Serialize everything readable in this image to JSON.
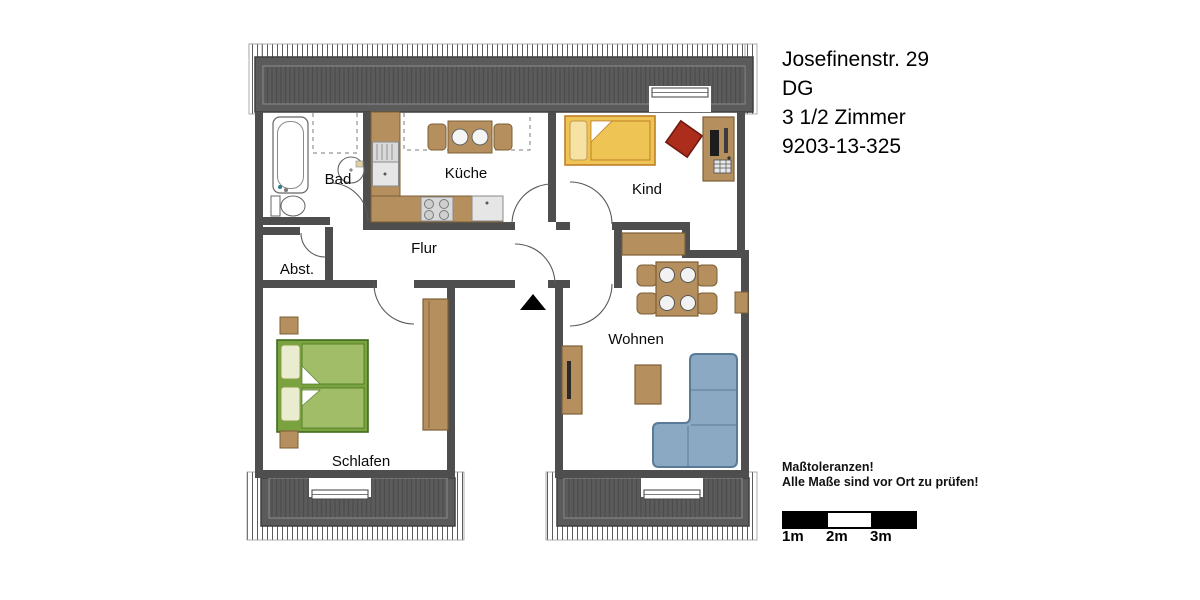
{
  "header": {
    "address": "Josefinenstr. 29",
    "floor": "DG",
    "rooms_count": "3 1/2 Zimmer",
    "reference": "9203-13-325"
  },
  "plan": {
    "rooms": {
      "bad": "Bad",
      "kueche": "Küche",
      "kind": "Kind",
      "flur": "Flur",
      "abst": "Abst.",
      "wohnen": "Wohnen",
      "schlafen": "Schlafen"
    }
  },
  "footer": {
    "tolerance_note_1": "Maßtoleranzen!",
    "tolerance_note_2": "Alle Maße sind vor Ort zu prüfen!",
    "scale_labels": [
      "1m",
      "2m",
      "3m"
    ]
  },
  "colors": {
    "wall": "#4e4e4e",
    "roof": "#5b5b5b",
    "roofstripe": "#4c4c4c",
    "tan": "#b5905e",
    "tanline": "#7c5f36",
    "yellow": "#eec455",
    "yellowlight": "#f6e2a2",
    "yellowline": "#bf7f28",
    "green": "#a2bd68",
    "greenlight": "#e9ecce",
    "greendark": "#7aa23e",
    "greenline": "#3f6c1d",
    "red": "#ac2d1c",
    "redline": "#6f1a0e",
    "sofa": "#8ca9c4",
    "sofaline": "#5a7b97",
    "gray": "#dcdcdc",
    "grayline": "#8a8a8a",
    "ink": "#000000"
  }
}
